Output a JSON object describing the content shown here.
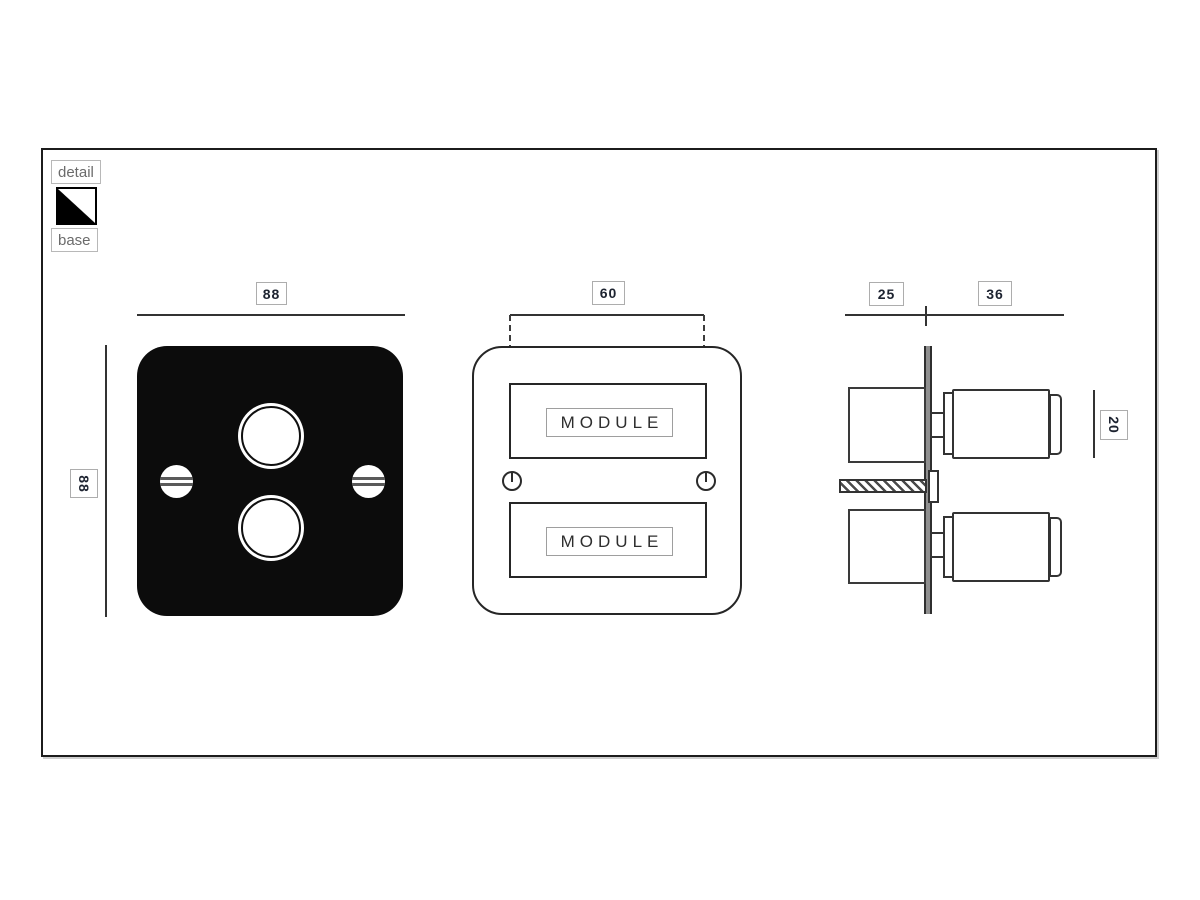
{
  "legend": {
    "detail_label": "detail",
    "base_label": "base"
  },
  "views": {
    "front_plate": {
      "width_dim": "88",
      "height_dim": "88"
    },
    "front_modules": {
      "spacing_dim": "60",
      "module_top": "MODULE",
      "module_bottom": "MODULE"
    },
    "side": {
      "behind_dim": "25",
      "front_dim": "36",
      "knob_dim": "20"
    }
  },
  "colors": {
    "line": "#333333",
    "plate_fill": "#0c0c0c",
    "dim_box_border": "#adadad",
    "digit_text": "#1d2330",
    "legend_text": "#6b6b6b",
    "wall_bar_fill": "#8f8f8f"
  }
}
